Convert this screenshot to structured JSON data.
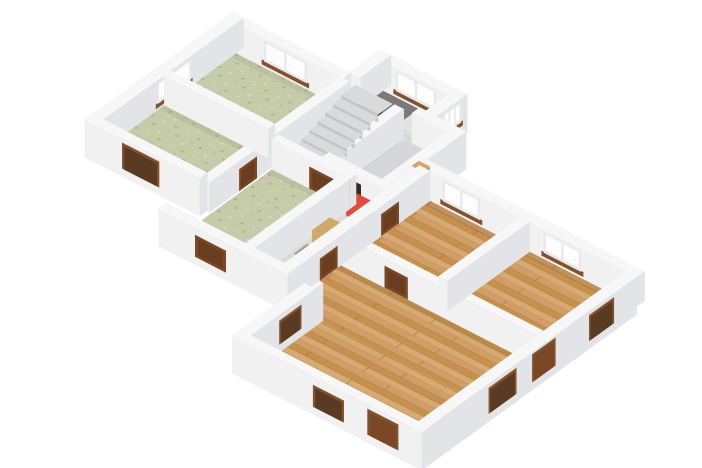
{
  "scene": {
    "type": "3d-floor-plan-render",
    "view": "isometric-from-south-west-above",
    "background": "#ffffff",
    "colors": {
      "wall_top": "#f7f7f8",
      "wall_face_sw": "#f1f1f2",
      "wall_face_se": "#e3e4e7",
      "slab_grey": "#e0e1e3",
      "floor_green": "#c6cbaa",
      "green_speckle_dark": "#b0b98c",
      "green_speckle_light": "#d8dcbf",
      "floor_wood": "#d09e66",
      "wood_dark": "#c6914f",
      "wood_light": "#d7a973",
      "wood_joint": "#a8743c",
      "floor_tile": "#dcded2",
      "tile_line": "#c9ccbc",
      "floor_bath": "#d5d7d9",
      "floor_entry": "#e1e2e4",
      "floor_dark": "#2e2a25",
      "shadow_dark": "rgba(40,36,32,0.55)",
      "door_brown": "#7a4827",
      "door_panel": "#6b3d20",
      "door_dark": "#3a2a1e",
      "opening_dark": "#5a3a22",
      "window_frame": "#e8e9ea",
      "window_glass": "#fdfdfd",
      "sill_brown": "#82512e",
      "stair_tread": "#d9dadc",
      "stair_riser": "#c3c5c8",
      "appliance_red": "#d23a31",
      "appliance_red_top": "#e04b40",
      "cabinet_wood": "#c09058",
      "cabinet_wood_top": "#d2a76b",
      "mat_grey": "#9aa0a3",
      "fixture_white": "#f4f5f6",
      "fixture_side": "#e9eaeb",
      "accent_teal": "#49a89b"
    },
    "rooms": [
      {
        "name": "bedroom-top-left",
        "floor": "green-speckled"
      },
      {
        "name": "bedroom-left",
        "floor": "green-speckled"
      },
      {
        "name": "hall-room-left",
        "floor": "green-speckled"
      },
      {
        "name": "stair-hall",
        "floor": "beige-tile"
      },
      {
        "name": "entry-porch",
        "floor": "grey"
      },
      {
        "name": "bathroom",
        "floor": "grey"
      },
      {
        "name": "corridor",
        "floor": "beige-tile"
      },
      {
        "name": "bedroom-right",
        "floor": "wood-parquet"
      },
      {
        "name": "bedroom-far-right",
        "floor": "wood-parquet"
      },
      {
        "name": "living-room",
        "floor": "wood-parquet"
      }
    ],
    "elements": [
      "staircase",
      "red-appliance",
      "wood-cabinet",
      "grey-mat",
      "bathroom-fixtures",
      "brown-doors",
      "white-windows",
      "brown-window-sills",
      "triple-porch-window",
      "dark-understair-void"
    ]
  }
}
